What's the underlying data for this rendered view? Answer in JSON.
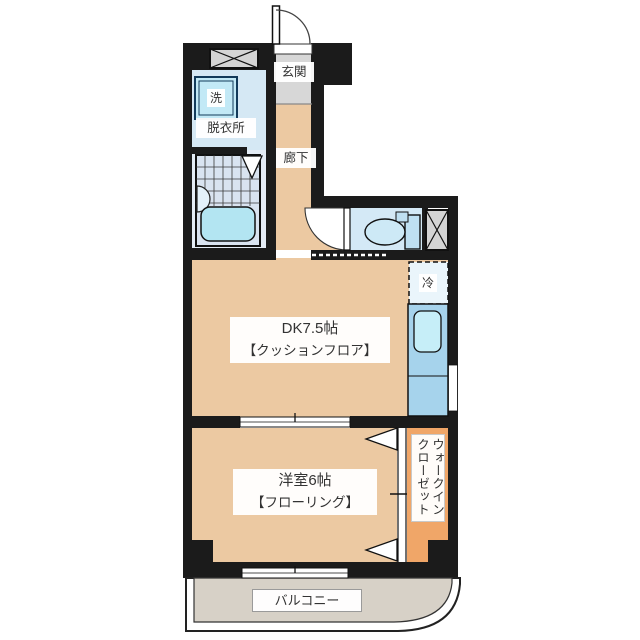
{
  "rooms": {
    "genkan": {
      "label": "玄関"
    },
    "hallway": {
      "label": "廊下"
    },
    "dressing": {
      "label": "脱衣所"
    },
    "washer": {
      "label": "洗"
    },
    "dk": {
      "name": "DK7.5帖",
      "floor": "【クッションフロア】"
    },
    "fridge": {
      "label": "冷"
    },
    "western": {
      "name": "洋室6帖",
      "floor": "【フローリング】"
    },
    "closet": {
      "label": "ウォークインクローゼット"
    },
    "balcony": {
      "label": "バルコニー"
    }
  },
  "colors": {
    "wall": "#1b1b1b",
    "floor_wood": "#ecc9a2",
    "floor_dressing": "#d5e8f4",
    "floor_bathroom": "#d9e3f0",
    "floor_toilet": "#d4e9f6",
    "floor_genkan": "#d7d7d7",
    "floor_closet": "#f0a668",
    "floor_balcony": "#d7d1c7",
    "kitchen_counter": "#a6d3ec",
    "kitchen_sink": "#c6eef8",
    "bathtub": "#b3e5f2",
    "hatch_box": "#d4d4d4",
    "fridge_space": "#eaf5fb"
  }
}
